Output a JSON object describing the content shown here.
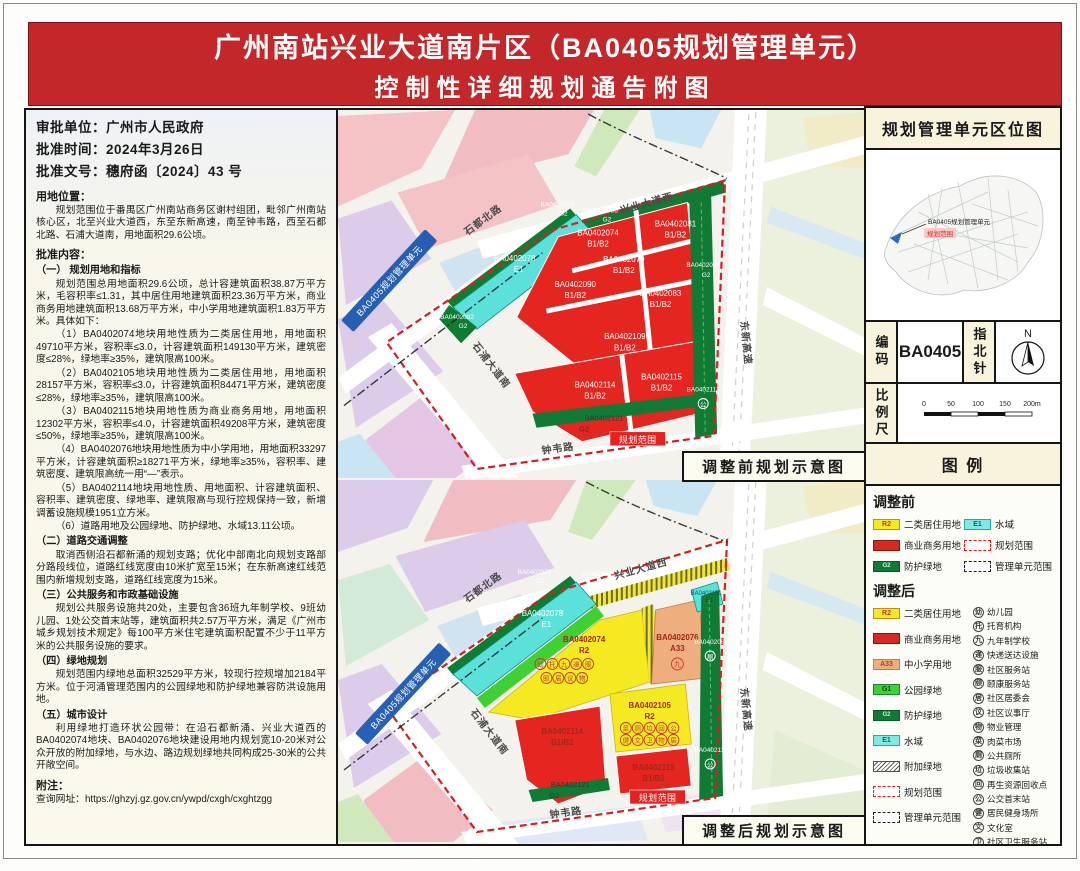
{
  "title": {
    "line1": "广州南站兴业大道南片区（BA0405规划管理单元）",
    "line2": "控制性详细规划通告附图"
  },
  "left_panel": {
    "approval": [
      "审批单位：广州市人民政府",
      "批准时间：2024年3月26日",
      "批准文号：穗府函〔2024〕43 号"
    ],
    "blocks": [
      "用地位置：",
      "规划范围位于番禺区广州南站商务区谢村组团，毗邻广州南站核心区，北至兴业大道西，东至东新高速，南至钟韦路，西至石都北路、石浦大道南，用地面积29.6公顷。",
      "批准内容：",
      "（一） 规划用地和指标",
      "规划范围总用地面积29.6公顷，总计容建筑面积38.87万平方米，毛容积率≤1.31，其中居住用地建筑面积23.36万平方米，商业商务用地建筑面积13.68万平方米，中小学用地建筑面积1.83万平方米。具体如下：",
      "（1）BA0402074地块用地性质为二类居住用地，用地面积49710平方米，容积率≤3.0，计容建筑面积149130平方米，建筑密度≤28%，绿地率≥35%，建筑限高100米。",
      "（2）BA0402105地块用地性质为二类居住用地，用地面积28157平方米，容积率≤3.0，计容建筑面积84471平方米，建筑密度≤28%，绿地率≥35%，建筑限高100米。",
      "（3）BA0402115地块用地性质为商业商务用地，用地面积12302平方米，容积率≤4.0，计容建筑面积49208平方米，建筑密度≤50%，绿地率≥35%，建筑限高100米。",
      "（4）BA0402076地块用地性质为中小学用地，用地面积33297平方米，计容建筑面积≥18271平方米，绿地率≥35%，容积率、建筑密度、建筑限高统一用“—”表示。",
      "（5）BA0402114地块用地性质、用地面积、计容建筑面积、容积率、建筑密度、绿地率、建筑限高与现行控规保持一致，新增调蓄设施规模1951立方米。",
      "（6）道路用地及公园绿地、防护绿地、水域13.11公顷。",
      "（二）道路交通调整",
      "取消西侧沿石都新涌的规划支路；优化中部南北向规划支路部分路段线位，道路红线宽度由10米扩宽至15米；在东新高速红线范围内新增规划支路，道路红线宽度为15米。",
      "（三）公共服务和市政基础设施",
      "规划公共服务设施共20处，主要包含36班九年制学校、9班幼儿园、1处公交首末站等，建筑面积共2.57万平方米，满足《广州市城乡规划技术规定》每100平方米住宅建筑面积配置不少于11平方米的公共服务设施的要求。",
      "（四）绿地规划",
      "规划范围内绿地总面积32529平方米，较现行控规增加2184平方米。位于河涌管理范围内的公园绿地和防护绿地兼容防洪设施用地。",
      "（五）城市设计",
      "利用绿地打造环状公园带：在沿石都新涌、兴业大道西的BA0402074地块、BA0402076地块建设用地内规划宽10-20米对公众开放的附加绿地，与水边、路边规划绿地共同构成25-30米的公共开敞空间。",
      "附注：",
      "查询网址：https://ghzyj.gz.gov.cn/ywpd/cxgh/cxghtzgg"
    ]
  },
  "maps": {
    "before": {
      "caption": "调整前规划示意图",
      "unit_banner": "BA0405规划管理单元",
      "scope_banner": "规划范围",
      "icon_117": "公",
      "roads": [
        "石都北路",
        "兴业大道西",
        "东新高速",
        "钟韦路",
        "石浦大道南"
      ],
      "parcels": [
        {
          "id": "BA0402073",
          "code": "G2"
        },
        {
          "id": "BA0402066",
          "code": "G2"
        },
        {
          "id": "BA0402078",
          "code": "E1"
        },
        {
          "id": "BA0402082",
          "code": "G2"
        },
        {
          "id": "BA0402074",
          "code": "B1/B2"
        },
        {
          "id": "BA0402079",
          "code": "B1/B2"
        },
        {
          "id": "BA0402081",
          "code": "B1/B2"
        },
        {
          "id": "BA0402086",
          "code": "G2"
        },
        {
          "id": "BA0402090",
          "code": "B1/B2"
        },
        {
          "id": "BA0402083",
          "code": "B1/B2"
        },
        {
          "id": "BA0402109",
          "code": "B1/B2"
        },
        {
          "id": "BA0402114",
          "code": "B1/B2"
        },
        {
          "id": "BA0402115",
          "code": "B1/B2"
        },
        {
          "id": "BA0402117",
          "code": "G2"
        },
        {
          "id": "BA0402121",
          "code": "G2"
        }
      ]
    },
    "after": {
      "caption": "调整后规划示意图",
      "unit_banner": "BA0405规划管理单元",
      "scope_banner": "规划范围",
      "roads": [
        "石都北路",
        "兴业大道西",
        "东新高速",
        "钟韦路",
        "石浦大道南"
      ],
      "parcels": [
        {
          "id": "BA0402073",
          "code": "G2"
        },
        {
          "id": "BA0402068",
          "code": "G1"
        },
        {
          "id": "BA0402078",
          "code": "E1"
        },
        {
          "id": "BA0402074",
          "code": "R2"
        },
        {
          "id": "BA0402076",
          "code": "A33"
        },
        {
          "id": "BA0402151",
          "code": "E1"
        },
        {
          "id": "BA0402086",
          "code": "G2"
        },
        {
          "id": "BA0402105",
          "code": "R2"
        },
        {
          "id": "BA0402114",
          "code": "B1/B2"
        },
        {
          "id": "BA0402115",
          "code": "B1/B2"
        },
        {
          "id": "BA0402117",
          "code": "G2"
        },
        {
          "id": "BA0402121",
          "code": "G2"
        }
      ],
      "icons_074": [
        "幼",
        "托",
        "九",
        "递",
        "服",
        "颐",
        "居",
        "议",
        "物"
      ],
      "icons_105": [
        "菜",
        "厕",
        "垃",
        "回",
        "公",
        "健",
        "文",
        "卫",
        "物",
        "居"
      ],
      "icon_076": "九",
      "icon_086": "厕",
      "icon_117": "公"
    }
  },
  "right_panel": {
    "location_map": {
      "title": "规划管理单元区位图",
      "callout_unit": "BA0405规划管理单元",
      "callout_scope": "规划范围"
    },
    "code_label": "编码",
    "code_value": "BA0405",
    "compass_label": "指北针",
    "compass_n": "N",
    "scale_label": "比例尺",
    "scale_ticks": [
      "0",
      "50",
      "100",
      "150",
      "200m"
    ],
    "legend_title": "图 例",
    "legend": {
      "before_heading": "调整前",
      "after_heading": "调整后",
      "before_items": [
        {
          "code": "R2",
          "label": "二类居住用地"
        },
        {
          "code": "",
          "label": "商业商务用地"
        },
        {
          "code": "G2",
          "label": "防护绿地"
        },
        {
          "code": "E1",
          "label": "水域"
        },
        {
          "code": "",
          "label": "规划范围"
        },
        {
          "code": "",
          "label": "管理单元范围"
        }
      ],
      "after_items": [
        {
          "code": "R2",
          "label": "二类居住用地"
        },
        {
          "code": "",
          "label": "商业商务用地"
        },
        {
          "code": "A33",
          "label": "中小学用地"
        },
        {
          "code": "G1",
          "label": "公园绿地"
        },
        {
          "code": "G2",
          "label": "防护绿地"
        },
        {
          "code": "E1",
          "label": "水域"
        },
        {
          "code": "",
          "label": "附加绿地"
        },
        {
          "code": "",
          "label": "规划范围"
        },
        {
          "code": "",
          "label": "管理单元范围"
        }
      ],
      "facilities": [
        {
          "glyph": "幼",
          "label": "幼儿园"
        },
        {
          "glyph": "托",
          "label": "托育机构"
        },
        {
          "glyph": "九",
          "label": "九年制学校"
        },
        {
          "glyph": "递",
          "label": "快递送达设施"
        },
        {
          "glyph": "服",
          "label": "社区服务站"
        },
        {
          "glyph": "颐",
          "label": "颐康服务站"
        },
        {
          "glyph": "居",
          "label": "社区居委会"
        },
        {
          "glyph": "议",
          "label": "社区议事厅"
        },
        {
          "glyph": "物",
          "label": "物业管理"
        },
        {
          "glyph": "菜",
          "label": "肉菜市场"
        },
        {
          "glyph": "厕",
          "label": "公共厕所"
        },
        {
          "glyph": "垃",
          "label": "垃圾收集站"
        },
        {
          "glyph": "回",
          "label": "再生资源回收点"
        },
        {
          "glyph": "公",
          "label": "公交首末站"
        },
        {
          "glyph": "健",
          "label": "居民健身场所"
        },
        {
          "glyph": "文",
          "label": "文化室"
        },
        {
          "glyph": "卫",
          "label": "社区卫生服务站"
        }
      ]
    }
  },
  "colors": {
    "title_bg": "#c4272a",
    "residential_r2": "#f5ea25",
    "commercial_b1b2": "#e42520",
    "school_a33": "#efae7d",
    "park_g1": "#3fd133",
    "protective_g2": "#117a35",
    "water_e1": "#5ce1da",
    "boundary_red": "#d81e1e",
    "unit_banner_blue": "#1b57b0"
  }
}
